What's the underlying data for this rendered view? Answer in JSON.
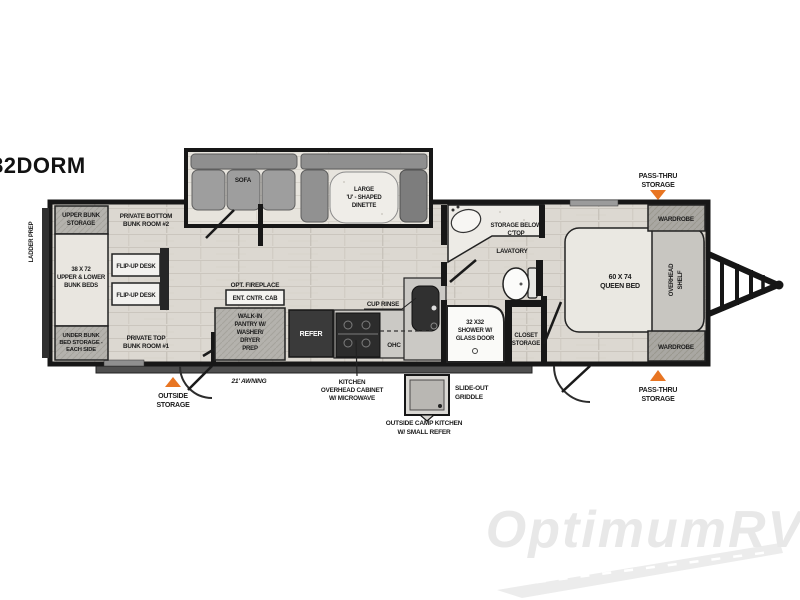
{
  "model": "282DORM",
  "watermark": "OptimumRV",
  "colors": {
    "accent_orange": "#E87522",
    "wall": "#171717",
    "floor": "#dcd8d1"
  },
  "labels": {
    "ladder_prep": "LADDER PREP",
    "upper_bunk_storage": [
      "UPPER BUNK",
      "STORAGE"
    ],
    "bunk_beds": [
      "38 X 72",
      "UPPER & LOWER",
      "BUNK BEDS"
    ],
    "under_bunk_storage": [
      "UNDER BUNK",
      "BED STORAGE -",
      "EACH SIDE"
    ],
    "bunk_room_2": [
      "PRIVATE BOTTOM",
      "BUNK ROOM #2"
    ],
    "bunk_room_1": [
      "PRIVATE TOP",
      "BUNK ROOM #1"
    ],
    "flip_up_desk_1": "FLIP-UP DESK",
    "flip_up_desk_2": "FLIP-UP DESK",
    "sofa": "SOFA",
    "dinette": [
      "LARGE",
      "'U' - SHAPED",
      "DINETTE"
    ],
    "opt_fireplace": "OPT. FIREPLACE",
    "ent_cntr_cab": "ENT. CNTR. CAB",
    "walk_in_pantry": [
      "WALK-IN",
      "PANTRY W/",
      "WASHER/",
      "DRYER",
      "PREP"
    ],
    "refer": "REFER",
    "ohc": "OHC",
    "cup_rinse": "CUP RINSE",
    "kitchen_ohc": [
      "KITCHEN",
      "OVERHEAD CABINET",
      "W/ MICROWAVE"
    ],
    "storage_below": [
      "STORAGE BELOW",
      "C'TOP"
    ],
    "lavatory": "LAVATORY",
    "shower": [
      "32 X32",
      "SHOWER W/",
      "GLASS DOOR"
    ],
    "closet_storage": [
      "CLOSET",
      "STORAGE"
    ],
    "queen_bed": [
      "60 X 74",
      "QUEEN BED"
    ],
    "overhead_shelf": [
      "OVERHEAD",
      "SHELF"
    ],
    "wardrobe_top": "WARDROBE",
    "wardrobe_bottom": "WARDROBE",
    "pass_thru_top": [
      "PASS-THRU",
      "STORAGE"
    ],
    "pass_thru_bottom": [
      "PASS-THRU",
      "STORAGE"
    ],
    "outside_storage": [
      "OUTSIDE",
      "STORAGE"
    ],
    "awning": "21' AWNING",
    "slide_out_griddle": [
      "SLIDE-OUT",
      "GRIDDLE"
    ],
    "outside_camp_kitchen": [
      "OUTSIDE CAMP KITCHEN",
      "W/ SMALL REFER"
    ]
  }
}
